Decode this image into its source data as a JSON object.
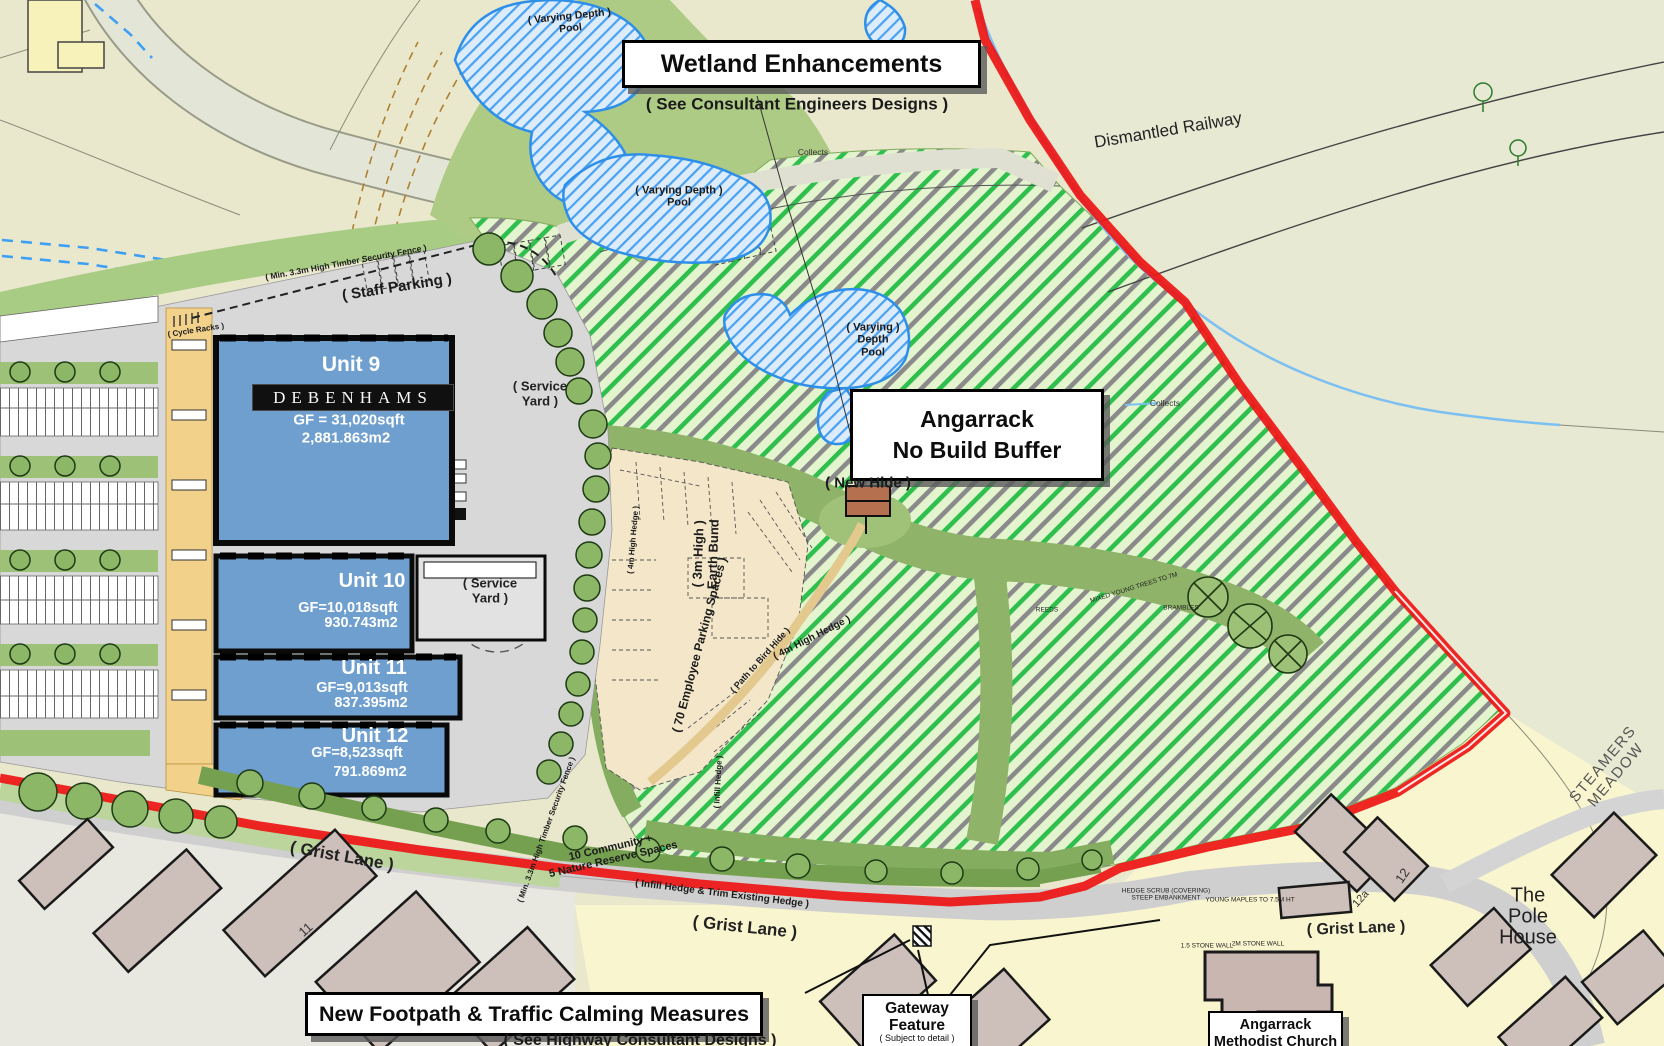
{
  "callouts": {
    "wetland": {
      "title": "Wetland Enhancements",
      "subtitle": "( See Consultant Engineers Designs )"
    },
    "no_build": {
      "line1": "Angarrack",
      "line2": "No Build Buffer"
    },
    "footpath": {
      "title": "New Footpath & Traffic Calming Measures",
      "subtitle": "( See Highway Consultant Designs )"
    },
    "gateway": {
      "line1": "Gateway",
      "line2": "Feature",
      "subtitle": "( Subject to detail )"
    },
    "church": {
      "line1": "Angarrack",
      "line2": "Methodist Church"
    }
  },
  "units": {
    "unit9": {
      "name": "Unit 9",
      "brand": "DEBENHAMS",
      "gf": "GF = 31,020sqft",
      "area": "2,881.863m2"
    },
    "unit10": {
      "name": "Unit 10",
      "gf": "GF=10,018sqft",
      "area": "930.743m2"
    },
    "unit11": {
      "name": "Unit 11",
      "gf": "GF=9,013sqft",
      "area": "837.395m2"
    },
    "unit12": {
      "name": "Unit 12",
      "gf": "GF=8,523sqft",
      "area": "791.869m2"
    }
  },
  "labels": {
    "dismantled_railway": "Dismantled Railway",
    "pool_a": {
      "l1": "( Varying Depth )",
      "l2": "Pool"
    },
    "pool_b": {
      "l1": "( Varying Depth )",
      "l2": "Pool"
    },
    "pool_c": {
      "l1": "( Varying )",
      "l2": "Depth",
      "l3": "Pool"
    },
    "collects": "Collects",
    "staff_parking": "( Staff Parking )",
    "security_fence": "( Min. 3.3m High Timber Security Fence )",
    "cycle_racks": "( Cycle Racks )",
    "service_yard": {
      "l1": "( Service",
      "l2": "Yard )"
    },
    "new_hide": "( New Hide )",
    "earth_bund": {
      "l1": "( 3m High )",
      "l2": "Earth Bund"
    },
    "employee_parking": "( 70 Employee Parking Spaces )",
    "hedge_4m": "( 4m High Hedge )",
    "path_bird_hide": "( Path to Bird Hide )",
    "infill_hedge": "( Infill Hedge )",
    "community": {
      "l1": "10 Community +",
      "l2": "5 Nature Reserve Spaces"
    },
    "infill_trim": "( Infill Hedge & Trim Existing Hedge )",
    "grist_lane": "( Grist Lane )",
    "pole_house": {
      "l1": "The",
      "l2": "Pole",
      "l3": "House"
    },
    "steamers": {
      "l1": "STEAMERS",
      "l2": "MEADOW"
    },
    "num_11": "11",
    "num_12": "12",
    "num_12a": "12a",
    "hedge_scrub": {
      "l1": "HEDGE SCRUB (COVERING)",
      "l2": "STEEP EMBANKMENT"
    },
    "young_maples": "YOUNG MAPLES TO 7.5M HT",
    "stone_wall_1": "1.5 STONE WALL",
    "stone_wall_2": "2M STONE WALL",
    "mixed_trees": "MIXED YOUNG TREES TO 7M",
    "brambles": "BRAMBLES",
    "reeds": "REEDS"
  },
  "colors": {
    "boundary_red": "#ee1515",
    "buffer_green_stripe": "#2fbf4e",
    "buffer_gray_stripe": "#8a8a8a",
    "pool_blue": "#2e8fe8",
    "unit_blue": "#6f9fce",
    "hide_brown": "#b5714f"
  }
}
